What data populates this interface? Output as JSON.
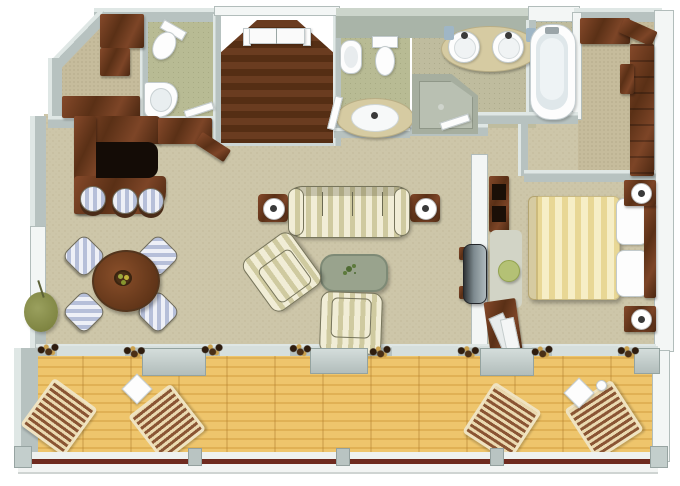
{
  "floor_plan": {
    "type": "3d-top-down-suite-floor-plan",
    "text_content": "none (image contains no readable text)",
    "rooms": [
      {
        "id": "entry-foyer",
        "floor": "dark-wood"
      },
      {
        "id": "walk-in-closet-left",
        "floor": "carpet"
      },
      {
        "id": "powder-room",
        "floor": "green-tile"
      },
      {
        "id": "wc-vanity-room",
        "floor": "green-tile"
      },
      {
        "id": "master-bathroom",
        "floor": "green-tile"
      },
      {
        "id": "bathtub-nook",
        "floor": "tile"
      },
      {
        "id": "dressing-room",
        "floor": "carpet"
      },
      {
        "id": "living-room",
        "floor": "carpet"
      },
      {
        "id": "dining-area",
        "floor": "carpet"
      },
      {
        "id": "wet-bar",
        "floor": "carpet"
      },
      {
        "id": "hallway",
        "floor": "carpet"
      },
      {
        "id": "bedroom",
        "floor": "carpet"
      },
      {
        "id": "balcony",
        "floor": "wood-deck"
      }
    ],
    "furniture": [
      {
        "id": "entry-double-door",
        "room": "entry-foyer"
      },
      {
        "id": "wardrobe-units",
        "room": "walk-in-closet-left"
      },
      {
        "id": "dresser",
        "room": "walk-in-closet-left"
      },
      {
        "id": "toilet",
        "room": "powder-room"
      },
      {
        "id": "corner-sink",
        "room": "powder-room"
      },
      {
        "id": "bidet",
        "room": "wc-vanity-room"
      },
      {
        "id": "toilet",
        "room": "wc-vanity-room"
      },
      {
        "id": "single-sink-vanity",
        "room": "wc-vanity-room"
      },
      {
        "id": "double-sink-vanity",
        "room": "master-bathroom"
      },
      {
        "id": "corner-shower",
        "room": "master-bathroom"
      },
      {
        "id": "bathtub",
        "room": "bathtub-nook"
      },
      {
        "id": "wardrobe-wall-units",
        "room": "dressing-room"
      },
      {
        "id": "bar-counter",
        "room": "wet-bar"
      },
      {
        "id": "bar-stools-x3",
        "room": "wet-bar"
      },
      {
        "id": "side-cabinet",
        "room": "entry-foyer"
      },
      {
        "id": "round-dining-table",
        "room": "dining-area"
      },
      {
        "id": "dining-chairs-x4",
        "room": "dining-area"
      },
      {
        "id": "potted-plant",
        "room": "living-room"
      },
      {
        "id": "striped-sofa",
        "room": "living-room"
      },
      {
        "id": "end-tables-with-lamps-x2",
        "room": "living-room"
      },
      {
        "id": "coffee-table-with-plant",
        "room": "living-room"
      },
      {
        "id": "armchairs-x2",
        "room": "living-room"
      },
      {
        "id": "wall-tv",
        "room": "living-room"
      },
      {
        "id": "shelf-unit",
        "room": "bedroom"
      },
      {
        "id": "rug",
        "room": "bedroom"
      },
      {
        "id": "ottoman",
        "room": "bedroom"
      },
      {
        "id": "desk-with-papers",
        "room": "bedroom"
      },
      {
        "id": "double-bed-striped-duvet",
        "room": "bedroom"
      },
      {
        "id": "pillows-x2",
        "room": "bedroom"
      },
      {
        "id": "nightstands-with-lamps-x2",
        "room": "bedroom"
      },
      {
        "id": "headboard-bench",
        "room": "bedroom"
      },
      {
        "id": "sun-loungers-x4",
        "room": "balcony"
      },
      {
        "id": "diamond-side-tables-x2",
        "room": "balcony"
      },
      {
        "id": "railing",
        "room": "balcony"
      },
      {
        "id": "door-thresholds-x4",
        "room": "balcony"
      },
      {
        "id": "curtain-bunches",
        "room": "balcony-doors"
      }
    ],
    "palette": {
      "carpet": "#cdc6a9",
      "carpet_dark": "#c6bc9c",
      "wall_gray": "#b7c2c0",
      "wall_white": "#f3f6f5",
      "wall_sage": "#a9b4a8",
      "wood_dark": "#5a3016",
      "wood_mid": "#7d4527",
      "entry_floor": "#6a3c20",
      "tile_green": "#b8bb94",
      "fixture_white": "#fdfdfd",
      "deck": "#eec56c",
      "deck_line": "#e0b155",
      "rail_maroon": "#6e2a1f",
      "fabric_cream": "#f1edd6",
      "fabric_olive": "#cfcaa0",
      "fabric_blue": "#b6bfd9",
      "duvet_yellow": "#e8d795",
      "coffee_table_green": "#99a38d",
      "plant_olive": "#8e9353"
    }
  }
}
